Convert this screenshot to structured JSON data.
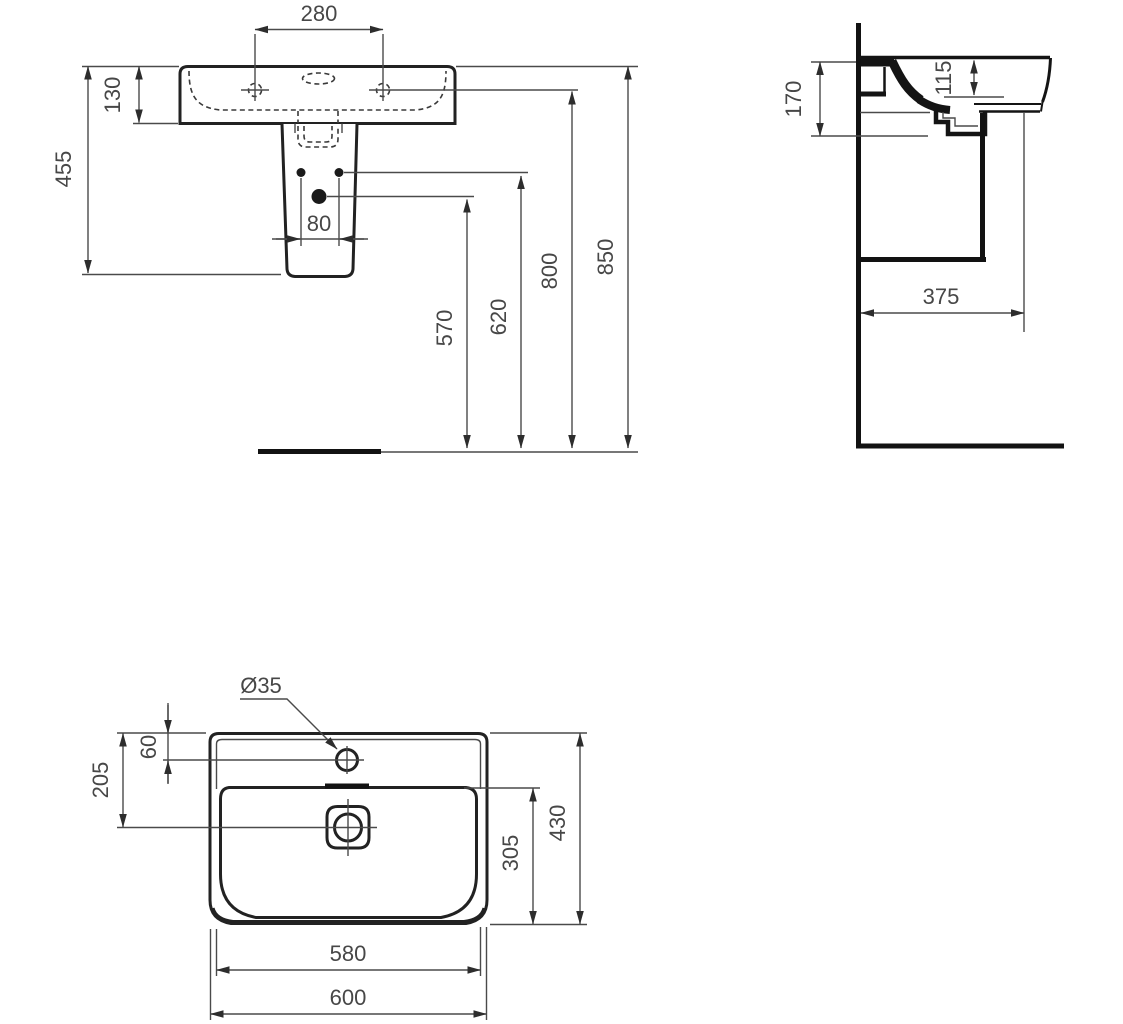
{
  "drawing": {
    "colors": {
      "line": "#222222",
      "text": "#474747",
      "background": "#ffffff"
    },
    "front_view": {
      "dims": {
        "tap_hole_spacing": "280",
        "basin_height": "130",
        "basin_bottom_height": "455",
        "fixing_hole_spacing": "80",
        "drain_hole_height": "570",
        "fixing_hole_height": "620",
        "tap_hole_height": "800",
        "rim_height": "850"
      }
    },
    "side_view": {
      "dims": {
        "front_depth": "170",
        "bowl_depth": "115",
        "projection": "375"
      }
    },
    "plan_view": {
      "dims": {
        "tap_hole_diameter": "Ø35",
        "tap_hole_offset": "60",
        "drain_offset": "205",
        "bowl_depth": "305",
        "overall_depth": "430",
        "bowl_width": "580",
        "overall_width": "600"
      }
    }
  }
}
